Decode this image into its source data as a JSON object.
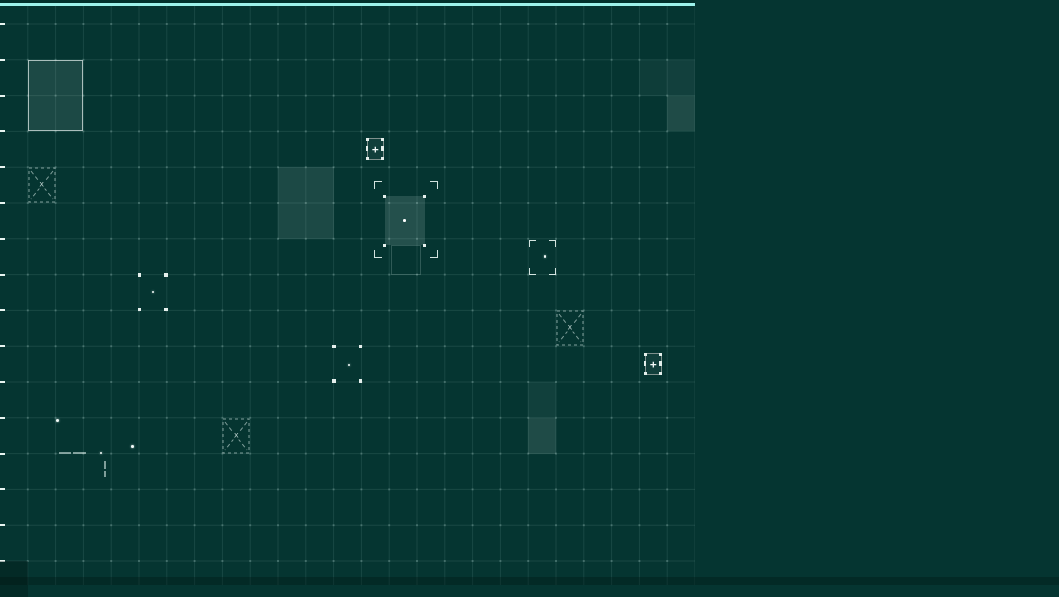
{
  "canvas": {
    "width": 1059,
    "height": 585
  },
  "colors": {
    "background": "#053531",
    "grid_line": "rgba(173,214,206,0.12)",
    "grid_dot": "rgba(205,238,231,0.22)",
    "top_edge": "#9df2ea",
    "top_edge_shadow": "#02312c",
    "tick": "#e8f4f1",
    "plus_box_border": "#7f918d",
    "plus_box_fill": "rgba(255,255,255,0.05)",
    "handle": "#e4efec",
    "bracket": "rgba(233,246,243,0.9)",
    "dashed": "rgba(228,244,240,0.55)",
    "selection_fill": "rgba(214,238,233,0.15)",
    "footprint_border": "rgba(216,240,235,0.2)",
    "shaded_fill_rgb": "238,252,249",
    "dark_fill_rgb": "0,20,16",
    "shaded_border": "rgba(225,236,233,0.72)",
    "dot": "#f3fbf9",
    "glyph": "#f4fbf9",
    "bottom_strip": "rgba(0,18,15,0.32)"
  },
  "grid": {
    "origin_x": 0,
    "origin_y": 24,
    "cell_w": 27.8,
    "cell_h": 35.8,
    "v_lines": 25,
    "h_lines": 16,
    "width": 695,
    "height": 585
  },
  "left_ticks": {
    "count": 16
  },
  "glyphs": {
    "plus": "+",
    "x": "x"
  },
  "shaded_zones": [
    {
      "col": 1,
      "row": 1,
      "cols": 2,
      "rows": 2,
      "opacity": 0.1,
      "border": true
    },
    {
      "col": 10,
      "row": 4,
      "cols": 2,
      "rows": 2,
      "opacity": 0.1
    },
    {
      "col": 23,
      "row": 1,
      "cols": 1,
      "rows": 1,
      "opacity": 0.045
    },
    {
      "col": 24,
      "row": 1,
      "cols": 1,
      "rows": 1,
      "opacity": 0.06
    },
    {
      "col": 24,
      "row": 2,
      "cols": 1,
      "rows": 1,
      "opacity": 0.115
    },
    {
      "col": 19,
      "row": 10,
      "cols": 1,
      "rows": 1,
      "opacity": 0.055
    },
    {
      "col": 19,
      "row": 11,
      "cols": 1,
      "rows": 1,
      "opacity": 0.115
    },
    {
      "col": 0,
      "row": 15,
      "cols": 1,
      "rows": 1,
      "opacity": 0.14,
      "dark": true
    }
  ],
  "markers": [
    {
      "type": "plus",
      "col": 13,
      "row": 3
    },
    {
      "type": "plus",
      "col": 23,
      "row": 9
    },
    {
      "type": "xcell",
      "col": 1,
      "row": 4
    },
    {
      "type": "xcell",
      "col": 8,
      "row": 11
    },
    {
      "type": "xcell",
      "col": 20,
      "row": 8
    },
    {
      "type": "handles",
      "col": 5,
      "row": 7,
      "dot": [
        12.5,
        16
      ]
    },
    {
      "type": "handles",
      "col": 12,
      "row": 9,
      "dot": [
        14,
        17.5
      ]
    },
    {
      "type": "brackets",
      "col": 19,
      "row": 6,
      "dot": [
        15.5,
        16.5
      ]
    }
  ],
  "selection": {
    "outer": {
      "x": 373.5,
      "y": 181,
      "w": 63,
      "h": 75.5
    },
    "inner": {
      "x": 384.5,
      "y": 196,
      "w": 40,
      "h": 49
    },
    "footprint": {
      "x": 390.5,
      "y": 245,
      "w": 30.5,
      "h": 29.5
    }
  },
  "dots": [
    {
      "x": 57.5,
      "y": 420.5,
      "r": 1.8
    },
    {
      "x": 132.5,
      "y": 446.5,
      "r": 1.4
    },
    {
      "x": 101,
      "y": 452.5,
      "r": 1.0
    }
  ],
  "dashes": [
    {
      "x": 59,
      "y": 452,
      "w": 12,
      "h": 1.5
    },
    {
      "x": 73,
      "y": 452,
      "w": 13,
      "h": 1.5
    },
    {
      "x": 104,
      "y": 461,
      "w": 1.5,
      "h": 8
    },
    {
      "x": 104,
      "y": 471,
      "w": 1.5,
      "h": 6
    }
  ]
}
